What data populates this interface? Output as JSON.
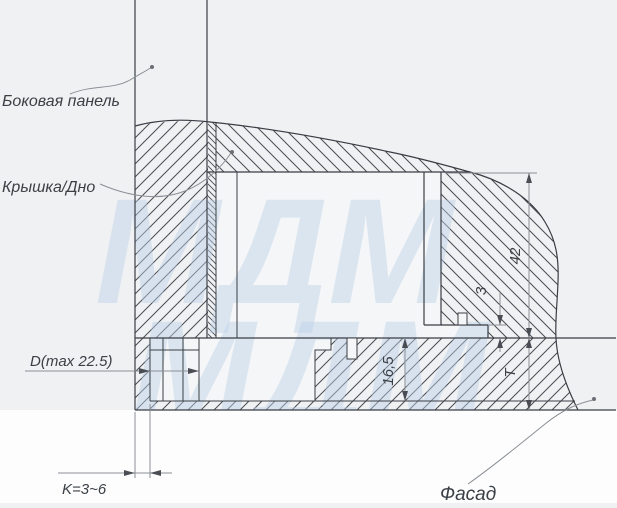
{
  "drawing": {
    "type": "furniture-fitting-cross-section",
    "labels": {
      "side_panel": "Боковая панель",
      "cover_bottom": "Крышка/Дно",
      "facade": "Фасад"
    },
    "dimensions": {
      "drill_diameter": "D(max 22.5)",
      "edge_gap": "K=3~6",
      "cavity_height": "42",
      "overlap": "3",
      "drill_depth": "16,5",
      "facade_thickness": "T"
    },
    "watermark": {
      "row1": "МДМ",
      "row2": "МДМ"
    },
    "colors": {
      "background": "#f0f1f3",
      "paper_below": "#fdfdfd",
      "cavity": "#f5f6f8",
      "line": "#3a3e44",
      "dimension_line": "#8b9096",
      "text": "#3b4046",
      "watermark": "#bdd2e8"
    }
  }
}
